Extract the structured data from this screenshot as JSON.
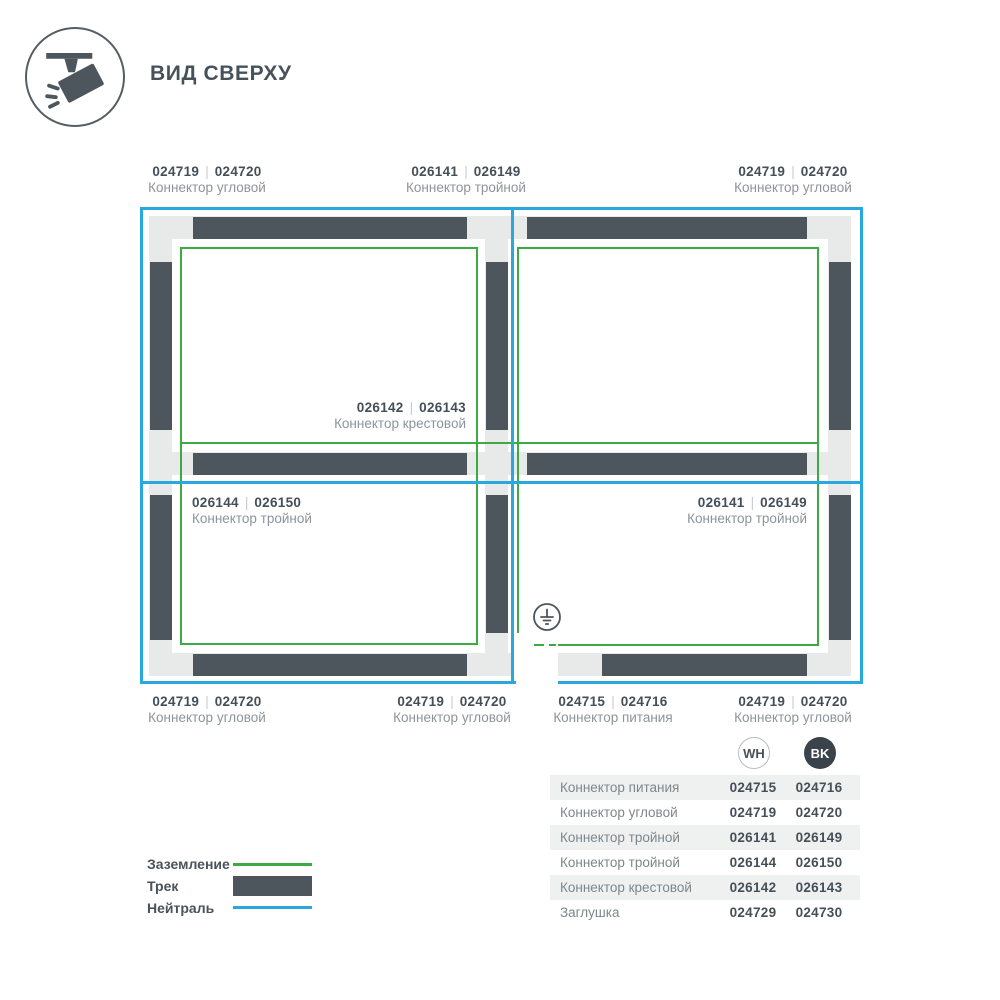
{
  "header": {
    "title": "ВИД СВЕРХУ",
    "icon": "track-spotlight-top-view-icon"
  },
  "diagram": {
    "separator": "|",
    "labels": [
      {
        "position": "top-left",
        "code_wh": "024719",
        "code_bk": "024720",
        "name": "Коннектор угловой"
      },
      {
        "position": "top-middle",
        "code_wh": "026141",
        "code_bk": "026149",
        "name": "Коннектор тройной"
      },
      {
        "position": "top-right",
        "code_wh": "024719",
        "code_bk": "024720",
        "name": "Коннектор угловой"
      },
      {
        "position": "center-cross",
        "code_wh": "026142",
        "code_bk": "026143",
        "name": "Коннектор крестовой"
      },
      {
        "position": "middle-left",
        "code_wh": "026144",
        "code_bk": "026150",
        "name": "Коннектор тройной"
      },
      {
        "position": "middle-right",
        "code_wh": "026141",
        "code_bk": "026149",
        "name": "Коннектор тройной"
      },
      {
        "position": "bottom-left",
        "code_wh": "024719",
        "code_bk": "024720",
        "name": "Коннектор угловой"
      },
      {
        "position": "bottom-middle-left",
        "code_wh": "024719",
        "code_bk": "024720",
        "name": "Коннектор угловой"
      },
      {
        "position": "bottom-middle-right",
        "code_wh": "024715",
        "code_bk": "024716",
        "name": "Коннектор питания"
      },
      {
        "position": "bottom-right",
        "code_wh": "024719",
        "code_bk": "024720",
        "name": "Коннектор угловой"
      }
    ],
    "ground_symbol": "earth-ground-icon"
  },
  "legend": {
    "items": [
      {
        "label": "Заземление",
        "swatch": "ground-line",
        "color": "#3cab43"
      },
      {
        "label": "Трек",
        "swatch": "track-bar",
        "color": "#4d565c"
      },
      {
        "label": "Нейтраль",
        "swatch": "neutral-line",
        "color": "#29a8e0"
      }
    ]
  },
  "table": {
    "columns": [
      {
        "badge": "WH"
      },
      {
        "badge": "BK"
      }
    ],
    "rows": [
      {
        "name": "Коннектор питания",
        "wh": "024715",
        "bk": "024716"
      },
      {
        "name": "Коннектор угловой",
        "wh": "024719",
        "bk": "024720"
      },
      {
        "name": "Коннектор тройной",
        "wh": "026141",
        "bk": "026149"
      },
      {
        "name": "Коннектор тройной",
        "wh": "026144",
        "bk": "026150"
      },
      {
        "name": "Коннектор крестовой",
        "wh": "026142",
        "bk": "026143"
      },
      {
        "name": "Заглушка",
        "wh": "024729",
        "bk": "024730"
      }
    ]
  }
}
